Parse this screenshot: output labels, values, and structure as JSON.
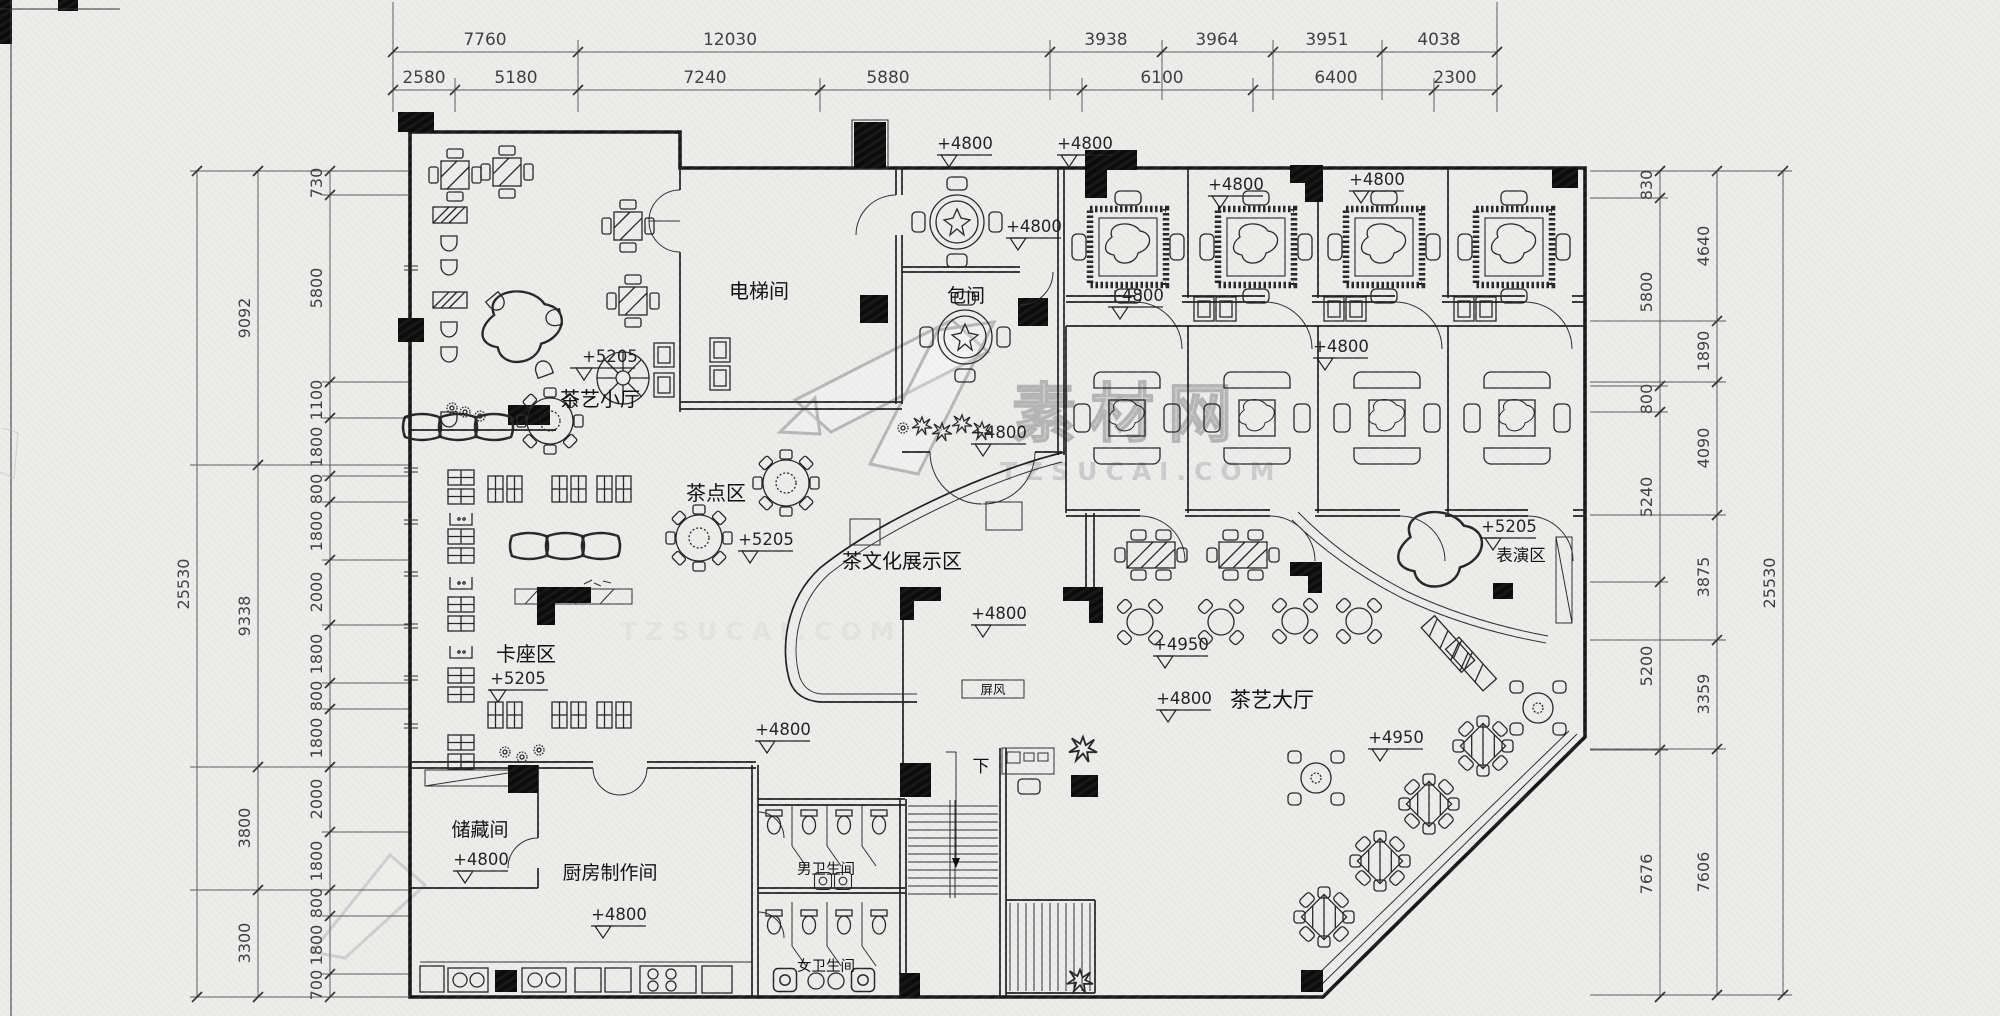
{
  "dims": {
    "top_row1": [
      "7760",
      "12030",
      "3938",
      "3964",
      "3951",
      "4038"
    ],
    "top_row2": [
      "2580",
      "5180",
      "7240",
      "5880",
      "6100",
      "6400",
      "2300"
    ],
    "left_inner": [
      "730",
      "5800",
      "1100",
      "1800",
      "800",
      "1800",
      "2000",
      "1800",
      "800",
      "1800",
      "2000",
      "1800",
      "800",
      "1800",
      "700"
    ],
    "left_mid": [
      "9092",
      "9338",
      "3800",
      "3300"
    ],
    "left_total": "25530",
    "right_inner": [
      "830",
      "5800",
      "800",
      "5240",
      "5200",
      "7676"
    ],
    "right_mid": [
      "4640",
      "1890",
      "4090",
      "3875",
      "3359",
      "7606"
    ],
    "right_total": "25530"
  },
  "rooms": {
    "tea_art_small": "茶艺小厅",
    "elevator": "电梯间",
    "private_room": "包间",
    "tea_snack": "茶点区",
    "tea_culture": "茶文化展示区",
    "booth": "卡座区",
    "storage": "储藏间",
    "kitchen": "厨房制作间",
    "men_wc": "男卫生间",
    "women_wc": "女卫生间",
    "tea_hall": "茶艺大厅",
    "stage": "表演区",
    "screen": "屏风",
    "stair_down": "下"
  },
  "elevations": {
    "e5205": "+5205",
    "e4800": "+4800",
    "e4950": "+4950"
  },
  "watermark": {
    "cn": "素材网",
    "url": "TZSUCAI.COM"
  },
  "colors": {
    "paper": "#ecedeb",
    "ink": "#161616",
    "dim_line": "#5a5a5a",
    "watermark": "#b5b5b5"
  }
}
